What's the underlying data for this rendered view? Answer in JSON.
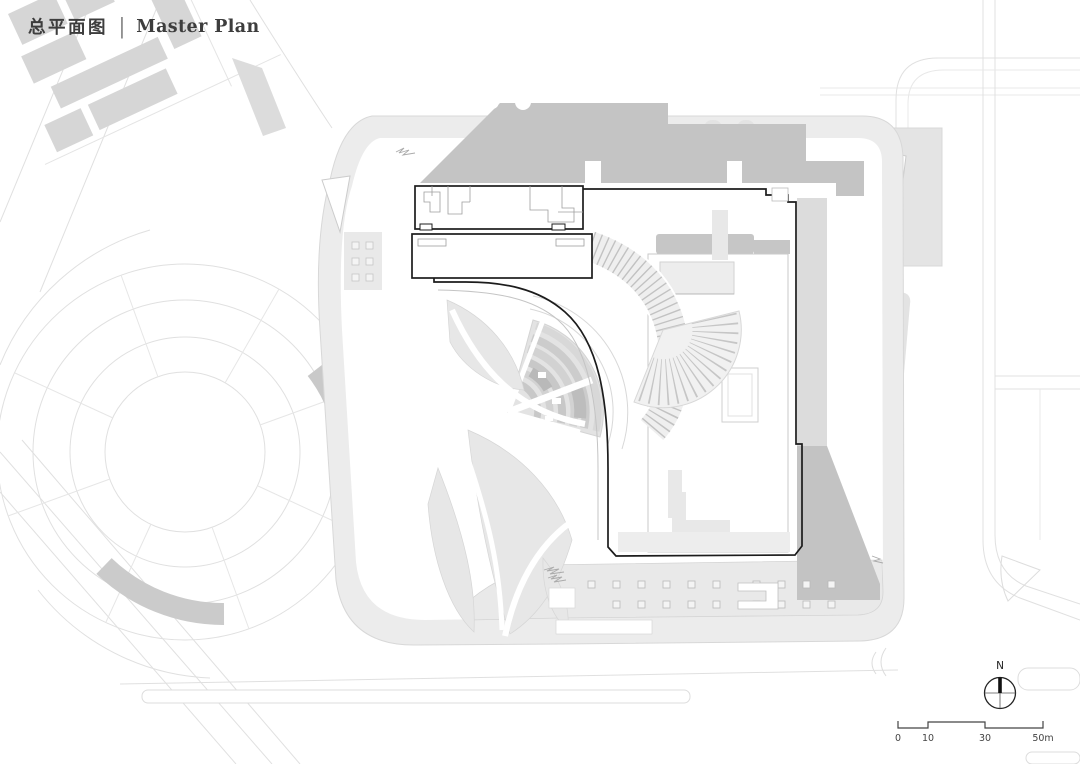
{
  "title": {
    "zh": "总平面图",
    "divider": "|",
    "en": "Master Plan"
  },
  "compass": {
    "label": "N"
  },
  "scale_bar": {
    "ticks": [
      "0",
      "10",
      "30",
      "50m"
    ]
  },
  "drawing": {
    "type": "architectural master plan",
    "features": [
      "main building complex outlined in black (two north bars + J-shaped podium boundary)",
      "fan-shaped terraced amphitheater landscape",
      "two curved hatched stairways",
      "organic leaf-shaped planting beds",
      "bottom plaza with grid of square planters",
      "circular park with concentric ring paths to the west",
      "tilted city block of grey context buildings top-left",
      "surrounding roads drawn as thin light grey lines",
      "building shadow cast to the north-east in medium grey"
    ]
  },
  "colors": {
    "background": "#ffffff",
    "site_pad": "#ececec",
    "shadow": "#c4c4c4",
    "context_building": "#d6d6d6",
    "building_outline": "#1c1c1c",
    "road_line": "#e0e0e0",
    "text": "#3d3d3d"
  }
}
